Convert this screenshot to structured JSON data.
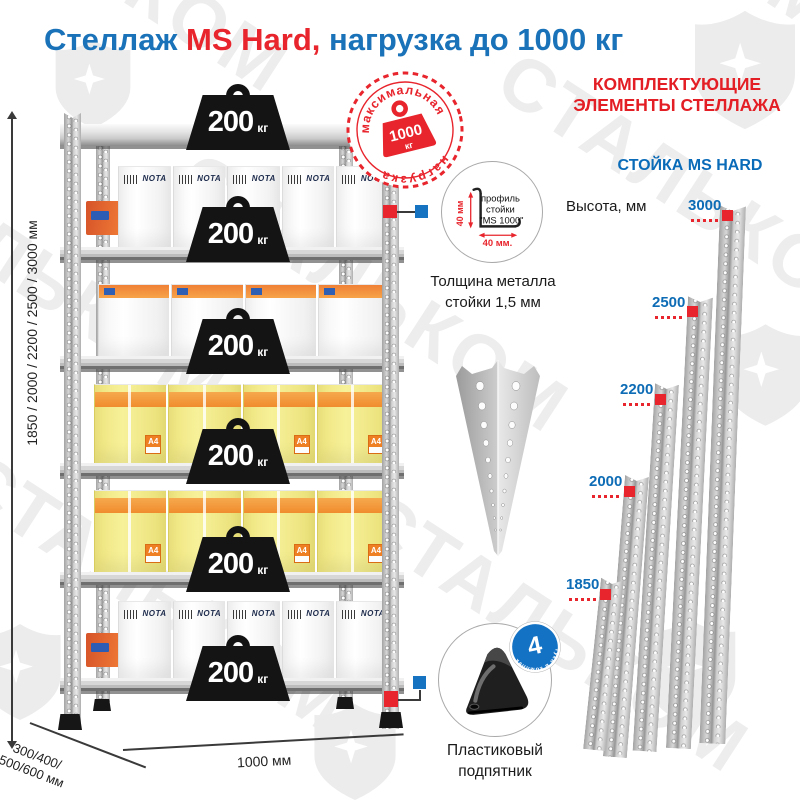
{
  "title": {
    "part1": "Стеллаж ",
    "part2": "MS Hard,",
    "part3": " нагрузка до 1000 кг"
  },
  "watermark": {
    "brand": "СТАЛЬКОМ"
  },
  "colors": {
    "accent_blue": "#1a72b8",
    "accent_red": "#e8242c",
    "label_blue": "#0d6cb5"
  },
  "shelf": {
    "weight_value": "200",
    "weight_unit": "кг",
    "max_load_stamp": {
      "top_text": "максимальная",
      "bottom_text": "нагрузка",
      "value": "1000",
      "unit": "кг"
    },
    "height_dimension": "1850 / 2000 / 2200 / 2500 / 3000 мм",
    "depth_dimension_line1": "300/400/",
    "depth_dimension_line2": "500/600 мм",
    "width_dimension": "1000 мм",
    "box_brand": "NOTA",
    "paper_label": "A4"
  },
  "details": {
    "profile": {
      "line1": "профиль",
      "line2": "стойки",
      "line3": "\"MS 1000\"",
      "dim_vertical": "40 мм",
      "dim_horizontal": "40 мм.",
      "caption_line1": "Толщина металла",
      "caption_line2": "стойки 1,5 мм"
    },
    "foot": {
      "caption_line1": "Пластиковый",
      "caption_line2": "подпятник",
      "badge_number": "4",
      "badge_text": "штуки в комплекте"
    }
  },
  "components": {
    "heading_line1": "КОМПЛЕКТУЮЩИЕ",
    "heading_line2": "ЭЛЕМЕНТЫ СТЕЛЛАЖА",
    "subheading": "СТОЙКА MS HARD",
    "height_label": "Высота, мм",
    "posts": [
      {
        "height": "3000"
      },
      {
        "height": "2500"
      },
      {
        "height": "2200"
      },
      {
        "height": "2000"
      },
      {
        "height": "1850"
      }
    ]
  }
}
